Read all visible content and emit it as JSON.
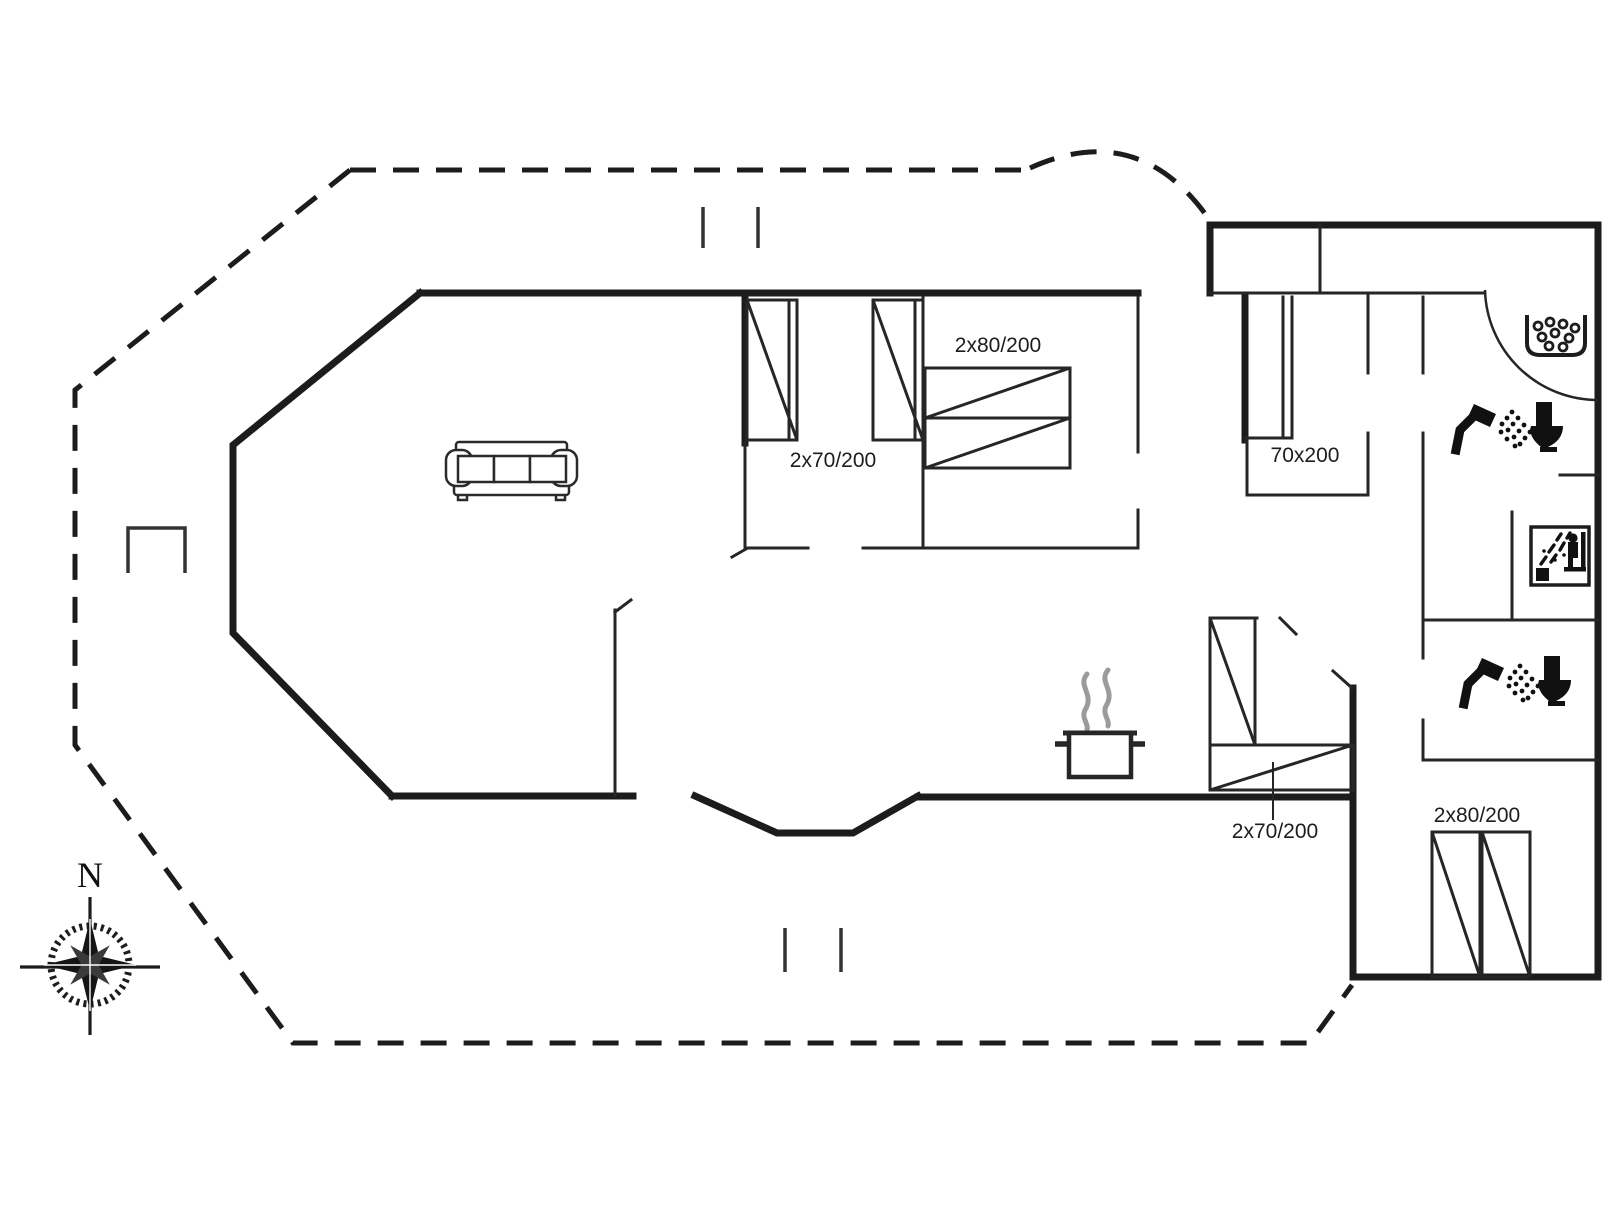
{
  "page": {
    "type": "house-floor-plan",
    "background": "#ffffff"
  },
  "colors": {
    "wall": "#1c1c1c",
    "thin_wall": "#262626",
    "icon": "#111111",
    "steam": "#9b9b9b"
  },
  "compass": {
    "north_label": "N"
  },
  "bed_labels": {
    "bedroom_top_left": "2x70/200",
    "bedroom_top_right": "2x80/200",
    "hall_alcove": "70x200",
    "bunk_alcove": "2x70/200",
    "bedroom_bottom_right": "2x80/200"
  },
  "icons": [
    {
      "name": "compass-rose-icon",
      "meaning": "north orientation"
    },
    {
      "name": "sofa-icon",
      "meaning": "living room couch"
    },
    {
      "name": "cooking-pot-icon",
      "meaning": "kitchen"
    },
    {
      "name": "whirlpool-tub-icon",
      "meaning": "bath with bubbles"
    },
    {
      "name": "shower-toilet-icon",
      "meaning": "bathroom with shower and WC"
    },
    {
      "name": "sauna-icon",
      "meaning": "sauna room"
    },
    {
      "name": "shower-toilet-icon",
      "meaning": "second bathroom with shower and WC"
    }
  ]
}
